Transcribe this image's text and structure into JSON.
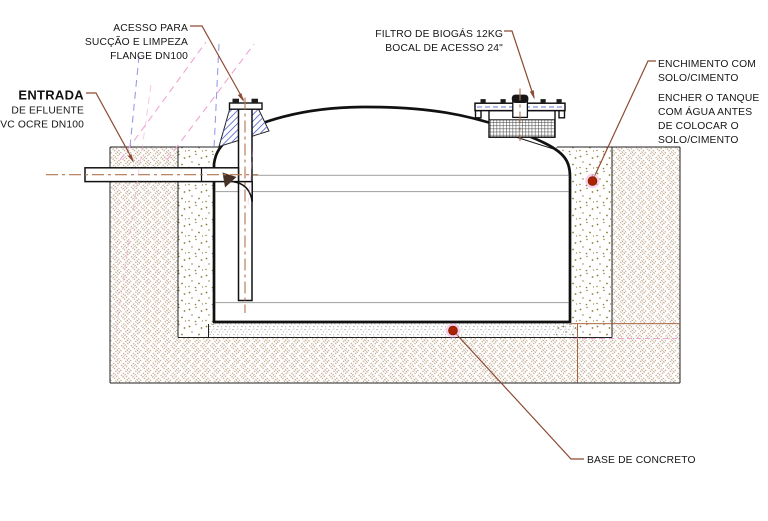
{
  "drawing_type": "tank-installation-cross-section",
  "labels": {
    "access": [
      "ACESSO PARA",
      "SUCÇÃO E LIMPEZA",
      "FLANGE DN100"
    ],
    "filter": [
      "FILTRO DE BIOGÁS 12KG",
      "BOCAL DE ACESSO 24\""
    ],
    "inlet_title": "ENTRADA",
    "inlet": [
      "DE EFLUENTE",
      "PVC OCRE DN100"
    ],
    "backfill": [
      "ENCHIMENTO COM",
      "SOLO/CIMENTO"
    ],
    "water_note": [
      "ENCHER O TANQUE",
      "COM ÁGUA ANTES",
      "DE COLOCAR O",
      "SOLO/CIMENTO"
    ],
    "base": "BASE DE CONCRETO"
  },
  "colors": {
    "ink": "#1a1a1a",
    "leader": "#8e4a32",
    "marker": "#ab2300",
    "marker_halo": "#f3aede",
    "earth": "#b59878",
    "sand": "#8c7c3a",
    "concrete": "#8f9398",
    "bluehatch": "#5f6fd0",
    "pink_dash": "#f0a3d2",
    "blue_dash": "#8789e6",
    "centerline": "#b2744e"
  }
}
